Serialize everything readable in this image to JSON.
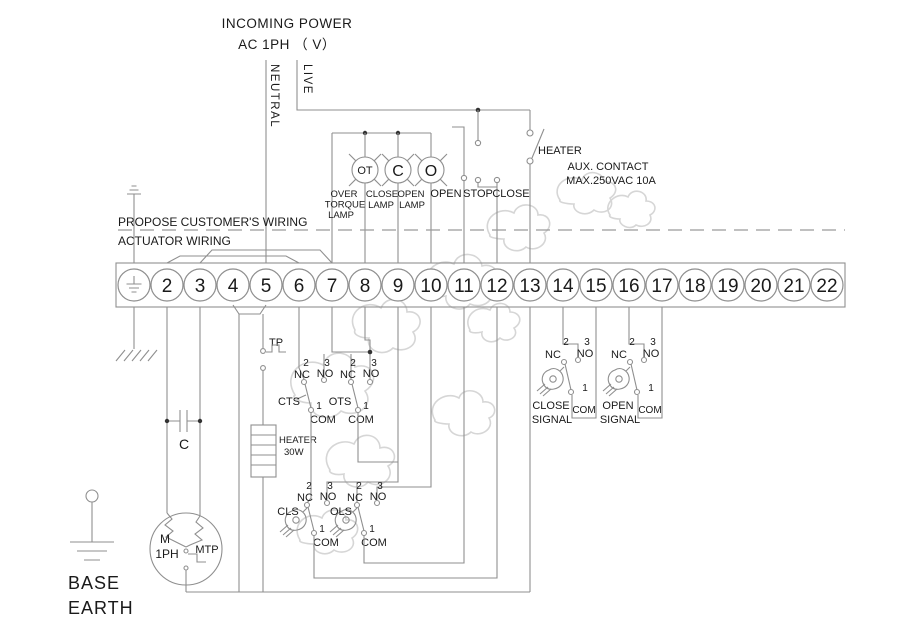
{
  "header": {
    "line1": "INCOMING POWER",
    "line2": "AC  1PH （ V）",
    "neutral": "NEUTRAL",
    "live": "LIVE"
  },
  "boundary": {
    "customer": "PROPOSE CUSTOMER'S WIRING",
    "actuator": "ACTUATOR WIRING"
  },
  "lamps": {
    "ot": {
      "symbol": "OT",
      "cap1": "OVER",
      "cap2": "TORQUE",
      "cap3": "LAMP"
    },
    "close": {
      "symbol": "C",
      "cap1": "CLOSE",
      "cap2": "LAMP"
    },
    "open": {
      "symbol": "O",
      "cap1": "OPEN",
      "cap2": "LAMP"
    }
  },
  "buttons": {
    "open": "OPEN",
    "stop": "STOP",
    "close": "CLOSE"
  },
  "heater_switch": {
    "label": "HEATER"
  },
  "aux": {
    "line1": "AUX. CONTACT",
    "line2": "MAX.250VAC 10A"
  },
  "terminals": {
    "labels": [
      "2",
      "3",
      "4",
      "5",
      "6",
      "7",
      "8",
      "9",
      "10",
      "11",
      "12",
      "13",
      "14",
      "15",
      "16",
      "17",
      "18",
      "19",
      "20",
      "21",
      "22"
    ]
  },
  "contact": {
    "n1": "1",
    "n2": "2",
    "n3": "3",
    "nc": "NC",
    "no": "NO",
    "com": "COM"
  },
  "components": {
    "tp": "TP",
    "cts": "CTS",
    "ots": "OTS",
    "cls": "CLS",
    "ols": "OLS",
    "heater1": "HEATER",
    "heater2": "30W",
    "capacitor": "C",
    "motor_m": "M",
    "motor_ph": "1PH",
    "motor_mtp": "MTP"
  },
  "signals": {
    "close1": "CLOSE",
    "close2": "SIGNAL",
    "open1": "OPEN",
    "open2": "SIGNAL"
  },
  "base_earth": {
    "line1": "BASE",
    "line2": "EARTH"
  },
  "colors": {
    "wire": "#8f8f8f",
    "text": "#1a1a1a",
    "watermark": "#d6d6d6"
  }
}
